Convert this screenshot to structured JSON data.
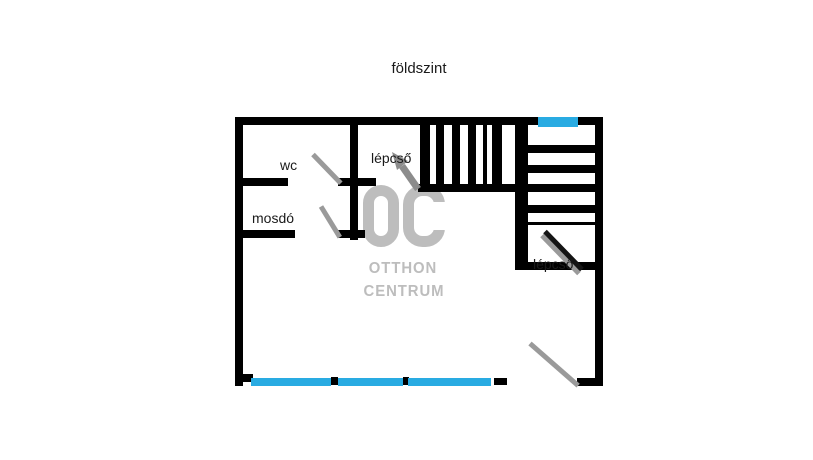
{
  "title": "földszint",
  "labels": {
    "wc": "wc",
    "mosdo": "mosdó",
    "stairs_upper": "lépcső",
    "stairs_lower": "lépcső"
  },
  "watermark": {
    "logo": "OC",
    "line1": "OTTHON",
    "line2": "CENTRUM"
  },
  "colors": {
    "wall": "#000000",
    "window": "#29abe2",
    "door": "#9a9a9a",
    "door-dark": "#141414",
    "arrow": "#8c8c8c",
    "watermark": "#bdbdbd",
    "text": "#1a1a1a",
    "bg": "#ffffff"
  }
}
